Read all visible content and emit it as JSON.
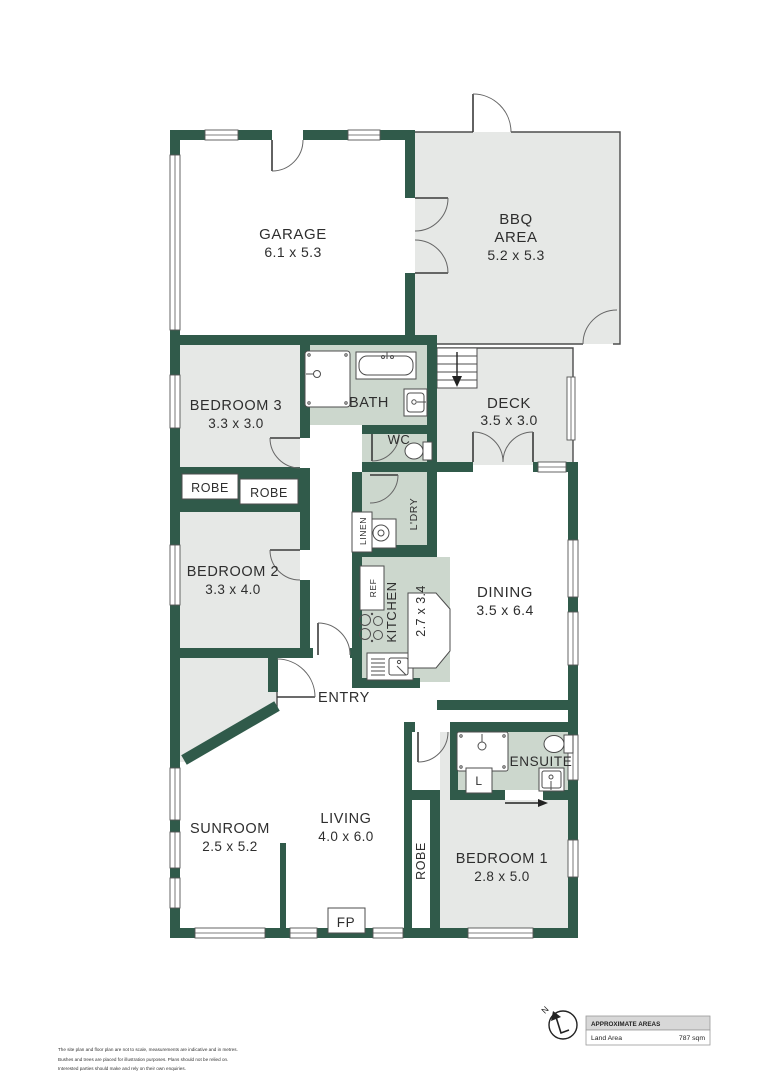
{
  "colors": {
    "wall": "#305a4a",
    "floor_gray": "#e6e8e6",
    "wet_area": "#ccd7cd",
    "outline": "#4d4d4d"
  },
  "rooms": {
    "garage": {
      "name": "GARAGE",
      "dims": "6.1 x 5.3"
    },
    "bbq_area": {
      "line1": "BBQ",
      "line2": "AREA",
      "dims": "5.2 x 5.3"
    },
    "deck": {
      "name": "DECK",
      "dims": "3.5 x 3.0"
    },
    "bedroom3": {
      "name": "BEDROOM 3",
      "dims": "3.3 x 3.0"
    },
    "bath": {
      "name": "BATH"
    },
    "wc": {
      "name": "WC"
    },
    "robe_bed3": {
      "name": "ROBE"
    },
    "robe_bed2": {
      "name": "ROBE"
    },
    "bedroom2": {
      "name": "BEDROOM 2",
      "dims": "3.3 x 4.0"
    },
    "linen": {
      "name": "LINEN"
    },
    "laundry": {
      "name": "L'DRY"
    },
    "kitchen": {
      "name": "KITCHEN",
      "dims": "2.7 x 3.4"
    },
    "fridge": {
      "name": "REF"
    },
    "dining": {
      "name": "DINING",
      "dims": "3.5 x 6.4"
    },
    "entry": {
      "name": "ENTRY"
    },
    "sunroom": {
      "name": "SUNROOM",
      "dims": "2.5 x 5.2"
    },
    "living": {
      "name": "LIVING",
      "dims": "4.0 x 6.0"
    },
    "fireplace": {
      "name": "FP"
    },
    "robe_bed1": {
      "name": "ROBE"
    },
    "bedroom1": {
      "name": "BEDROOM 1",
      "dims": "2.8 x 5.0"
    },
    "ensuite": {
      "name": "ENSUITE"
    },
    "linen_ensuite": {
      "name": "L"
    }
  },
  "compass": {
    "north_label": "N"
  },
  "areas_box": {
    "title": "APPROXIMATE AREAS",
    "rows": [
      {
        "label": "Land Area",
        "value": "787 sqm"
      }
    ]
  },
  "disclaimer": {
    "line1": "The site plan and floor plan are not to scale, measurements are indicative and in metres.",
    "line2": "Bushes and trees are placed for illustration purposes. Plans should not be relied on.",
    "line3": "Interested parties should make and rely on their own enquiries."
  }
}
